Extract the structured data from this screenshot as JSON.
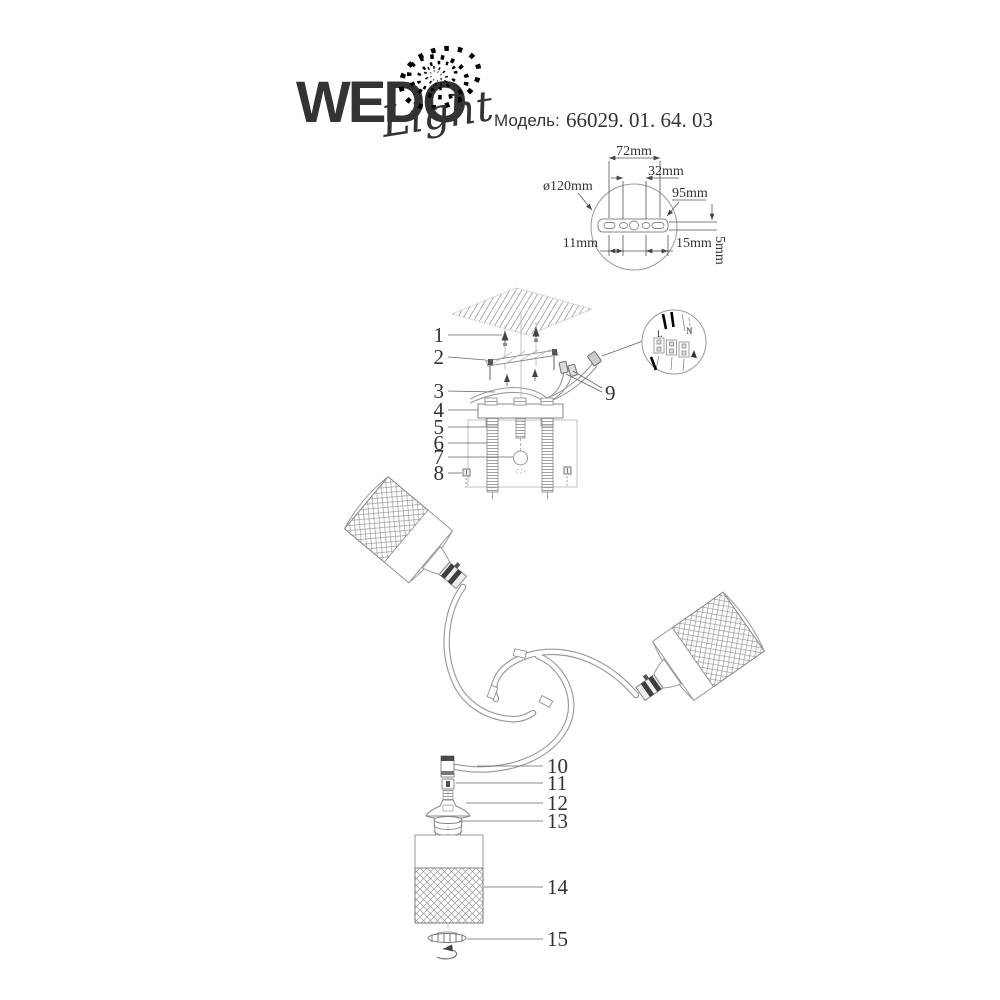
{
  "brand": {
    "wordmark": "WEDO",
    "script": "Light"
  },
  "model": {
    "label": "Модель:",
    "number": "66029. 01. 64. 03"
  },
  "mounting_plate": {
    "diameter": "ø120mm",
    "hole_span": "72mm",
    "center_span": "32mm",
    "plate_width": "95mm",
    "slot_left": "11mm",
    "slot_right": "15mm",
    "thickness": "5mm"
  },
  "wiring": {
    "live": "L",
    "neutral": "N"
  },
  "parts": [
    "1",
    "2",
    "3",
    "4",
    "5",
    "6",
    "7",
    "8",
    "9",
    "10",
    "11",
    "12",
    "13",
    "14",
    "15"
  ]
}
